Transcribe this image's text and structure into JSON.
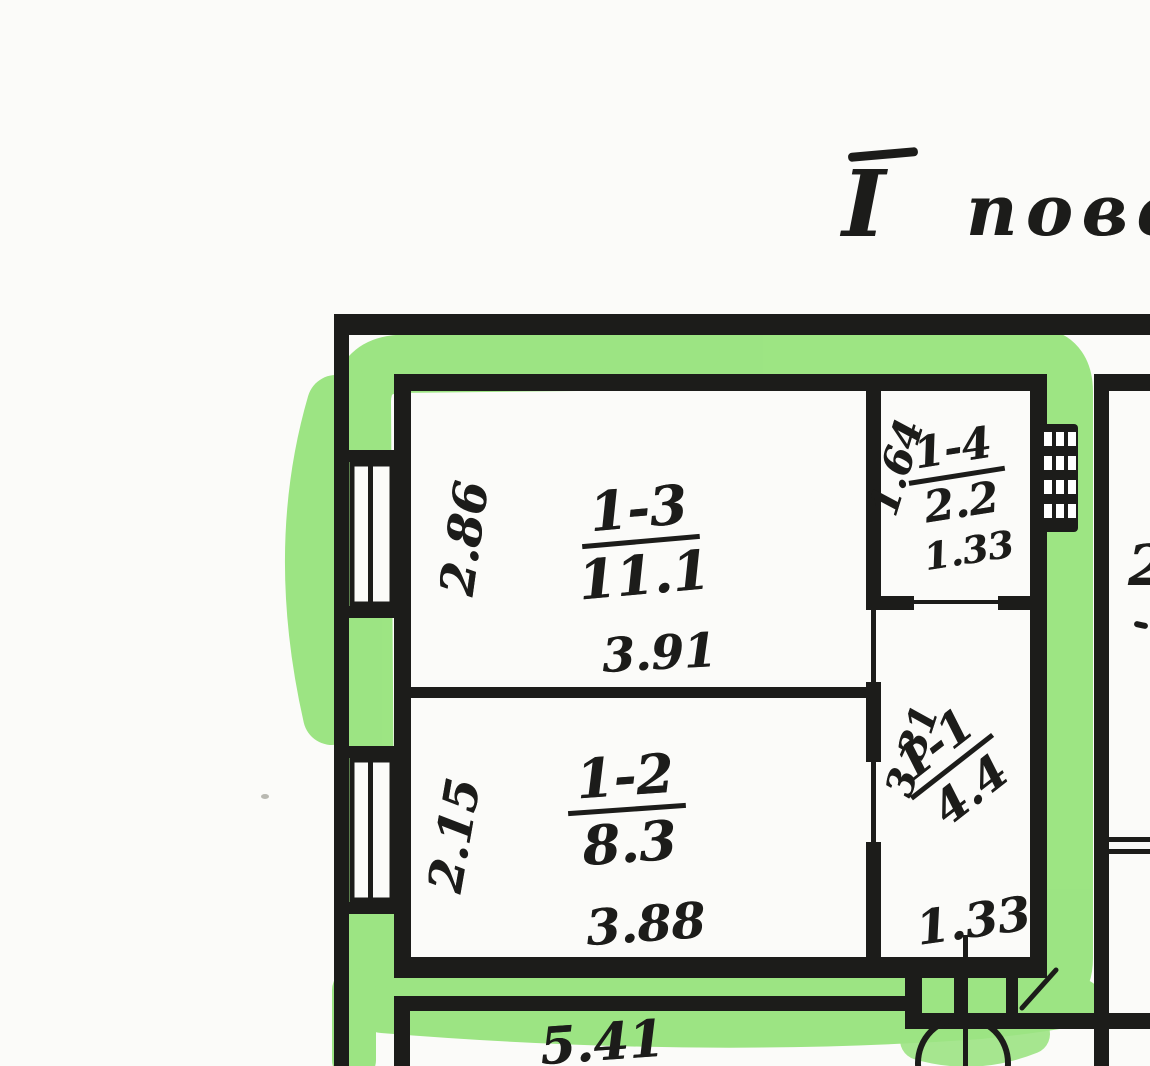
{
  "title": {
    "numeral": "I",
    "word": "пове"
  },
  "colors": {
    "highlight_green": "#8ce06f",
    "ink": "#1c1c1a",
    "paper": "#fbfbf9"
  },
  "rooms": {
    "r13": {
      "number": "1-3",
      "area": "11.1",
      "width": "3.91",
      "depth": "2.86"
    },
    "r12": {
      "number": "1-2",
      "area": "8.3",
      "width": "3.88",
      "depth": "2.15"
    },
    "r14": {
      "number": "1-4",
      "area": "2.2",
      "width": "1.33",
      "depth": "1.64"
    },
    "r11": {
      "number": "1-1",
      "area": "4.4",
      "width": "1.33",
      "depth": "3.31"
    }
  },
  "dimensions": {
    "lower_room_width": "5.41",
    "right_edge_partial": "2"
  }
}
